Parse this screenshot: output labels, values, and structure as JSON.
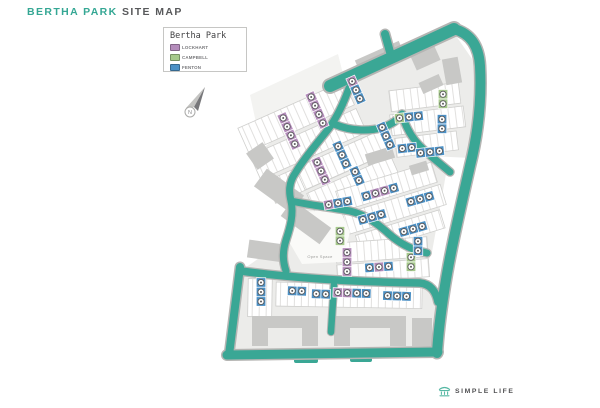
{
  "header": {
    "title_accent": "BERTHA PARK",
    "title_rest": "SITE MAP"
  },
  "legend": {
    "title": "Bertha Park",
    "items": [
      {
        "id": "lockhart",
        "label": "LOCKHART",
        "color": "#b48cbb"
      },
      {
        "id": "campbell",
        "label": "CAMPBELL",
        "color": "#a6c98b"
      },
      {
        "id": "fenton",
        "label": "FENTON",
        "color": "#4b90c5"
      }
    ]
  },
  "compass": {
    "label": "N"
  },
  "map": {
    "open_space_label": "Open Space",
    "colors": {
      "accent": "#35a794",
      "road": "#3aa795",
      "road_casing": "#b5b5b3",
      "plot_area": "#ececea",
      "building": "#c8c8c6",
      "brand": "#56b8a4"
    },
    "markers": [
      {
        "x": 356,
        "y": 90,
        "angle": -24,
        "dir": "v",
        "units": [
          "lockhart",
          "fenton",
          "fenton"
        ]
      },
      {
        "x": 317,
        "y": 110,
        "angle": -24,
        "dir": "v",
        "units": [
          "lockhart",
          "lockhart",
          "lockhart",
          "lockhart"
        ]
      },
      {
        "x": 289,
        "y": 131,
        "angle": -24,
        "dir": "v",
        "units": [
          "lockhart",
          "lockhart",
          "lockhart",
          "lockhart"
        ]
      },
      {
        "x": 386,
        "y": 136,
        "angle": -24,
        "dir": "v",
        "units": [
          "fenton",
          "fenton",
          "fenton"
        ]
      },
      {
        "x": 443,
        "y": 99,
        "angle": 0,
        "dir": "v",
        "units": [
          "campbell",
          "campbell"
        ]
      },
      {
        "x": 409,
        "y": 117,
        "angle": -6,
        "dir": "h",
        "units": [
          "campbell",
          "fenton",
          "fenton"
        ]
      },
      {
        "x": 442,
        "y": 124,
        "angle": 0,
        "dir": "v",
        "units": [
          "fenton",
          "fenton"
        ]
      },
      {
        "x": 407,
        "y": 148,
        "angle": -6,
        "dir": "h",
        "units": [
          "fenton",
          "fenton"
        ]
      },
      {
        "x": 430,
        "y": 152,
        "angle": -6,
        "dir": "h",
        "units": [
          "fenton",
          "fenton",
          "fenton"
        ]
      },
      {
        "x": 342,
        "y": 155,
        "angle": -24,
        "dir": "v",
        "units": [
          "fenton",
          "fenton",
          "fenton"
        ]
      },
      {
        "x": 321,
        "y": 171,
        "angle": -24,
        "dir": "v",
        "units": [
          "lockhart",
          "lockhart",
          "lockhart"
        ]
      },
      {
        "x": 357,
        "y": 176,
        "angle": -24,
        "dir": "v",
        "units": [
          "fenton",
          "fenton"
        ]
      },
      {
        "x": 380,
        "y": 192,
        "angle": -16,
        "dir": "h",
        "units": [
          "fenton",
          "lockhart",
          "lockhart",
          "fenton"
        ]
      },
      {
        "x": 420,
        "y": 199,
        "angle": -16,
        "dir": "h",
        "units": [
          "fenton",
          "fenton",
          "fenton"
        ]
      },
      {
        "x": 338,
        "y": 203,
        "angle": -10,
        "dir": "h",
        "units": [
          "lockhart",
          "fenton",
          "fenton"
        ]
      },
      {
        "x": 372,
        "y": 217,
        "angle": -16,
        "dir": "h",
        "units": [
          "fenton",
          "fenton",
          "fenton"
        ]
      },
      {
        "x": 413,
        "y": 229,
        "angle": -16,
        "dir": "h",
        "units": [
          "fenton",
          "fenton",
          "fenton"
        ]
      },
      {
        "x": 340,
        "y": 236,
        "angle": 0,
        "dir": "v",
        "units": [
          "campbell",
          "campbell"
        ]
      },
      {
        "x": 347,
        "y": 262,
        "angle": 0,
        "dir": "v",
        "units": [
          "lockhart",
          "lockhart",
          "lockhart"
        ]
      },
      {
        "x": 379,
        "y": 267,
        "angle": -4,
        "dir": "h",
        "units": [
          "fenton",
          "lockhart",
          "fenton"
        ]
      },
      {
        "x": 411,
        "y": 262,
        "angle": 0,
        "dir": "v",
        "units": [
          "campbell",
          "campbell"
        ]
      },
      {
        "x": 418,
        "y": 246,
        "angle": 0,
        "dir": "v",
        "units": [
          "fenton",
          "fenton"
        ]
      },
      {
        "x": 261,
        "y": 292,
        "angle": 0,
        "dir": "v",
        "units": [
          "fenton",
          "fenton",
          "fenton"
        ]
      },
      {
        "x": 297,
        "y": 291,
        "angle": 2,
        "dir": "h",
        "units": [
          "fenton",
          "fenton"
        ]
      },
      {
        "x": 321,
        "y": 294,
        "angle": 2,
        "dir": "h",
        "units": [
          "fenton",
          "fenton"
        ]
      },
      {
        "x": 352,
        "y": 293,
        "angle": 2,
        "dir": "h",
        "units": [
          "lockhart",
          "lockhart",
          "fenton",
          "fenton"
        ]
      },
      {
        "x": 397,
        "y": 296,
        "angle": 2,
        "dir": "h",
        "units": [
          "fenton",
          "fenton",
          "fenton"
        ]
      }
    ]
  },
  "footer": {
    "brand": "SIMPLE LIFE"
  }
}
